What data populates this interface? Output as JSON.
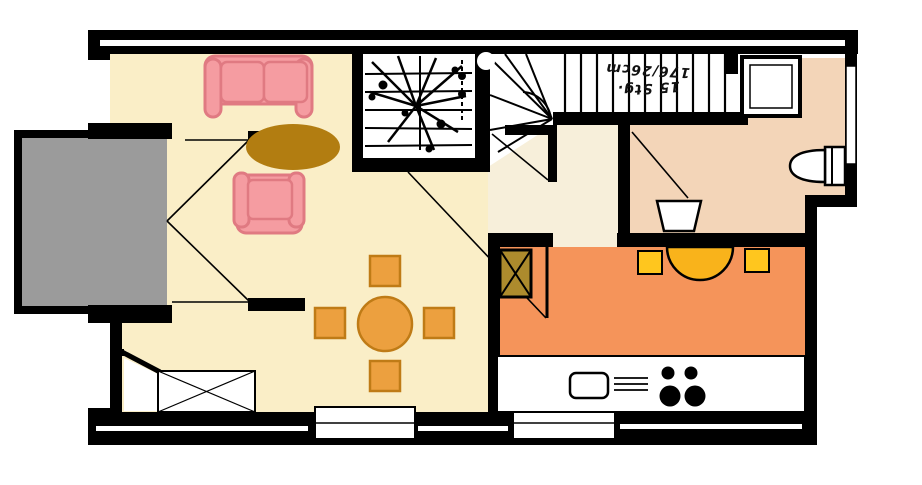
{
  "document": {
    "type": "floor-plan",
    "style": "scanned architectural ground-floor plan with colored rooms"
  },
  "stairs": {
    "annotation_line1": "15 Stg.",
    "annotation_line2": "176/26cm",
    "annotation_orientation": "upside-down"
  },
  "colors": {
    "wall": "#000000",
    "outline_white": "#FFFFFF",
    "living_floor": "#FAEEC7",
    "hall_floor": "#F7EFDA",
    "kitchen_floor": "#F5945A",
    "bathroom_floor": "#F3D5B8",
    "terrace": "#9B9B9B",
    "stair_floor": "#FFFFFF",
    "sofa_fill": "#F59CA1",
    "sofa_border": "#E07A82",
    "coffee_table": "#B27D11",
    "dining_fill": "#ECA03F",
    "dining_border": "#BF7B16",
    "kitchen_chair": "#FFC61E",
    "kitchen_table": "#F9B31B",
    "cabinet_gold": "#AD8B2D"
  },
  "rooms": [
    {
      "name": "living-room",
      "color_key": "living_floor"
    },
    {
      "name": "hall",
      "color_key": "hall_floor"
    },
    {
      "name": "kitchen",
      "color_key": "kitchen_floor"
    },
    {
      "name": "bathroom",
      "color_key": "bathroom_floor"
    },
    {
      "name": "terrace",
      "color_key": "terrace"
    },
    {
      "name": "staircase",
      "color_key": "stair_floor"
    }
  ],
  "furniture": [
    "sofa",
    "armchair",
    "coffee-table",
    "dining-table",
    "dining-chairs",
    "kitchen-table",
    "kitchen-chairs",
    "refrigerator-cabinet",
    "kitchen-counter",
    "kitchen-sink",
    "stove",
    "toilet",
    "shower",
    "bathroom-sink",
    "entrance-cabinet"
  ]
}
